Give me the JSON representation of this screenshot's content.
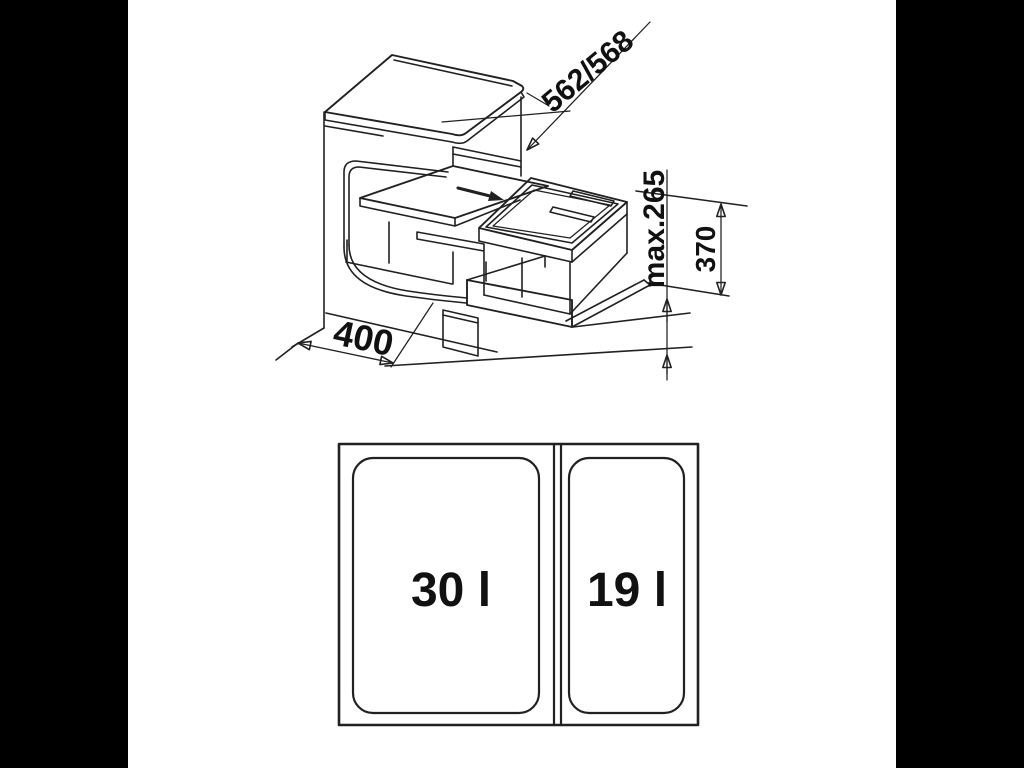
{
  "colors": {
    "letterbox": "#000000",
    "background": "#ffffff",
    "line": "#212121",
    "label": "#111111"
  },
  "diagram": {
    "isometric_view": {
      "description": "cabinet with pull-out board and waste-bin frame",
      "labels": {
        "depth": "562/568",
        "max_height": "max.265",
        "unit_height": "370",
        "width": "400"
      }
    },
    "top_view": {
      "left_bin": "30 l",
      "right_bin": "19 l"
    }
  }
}
